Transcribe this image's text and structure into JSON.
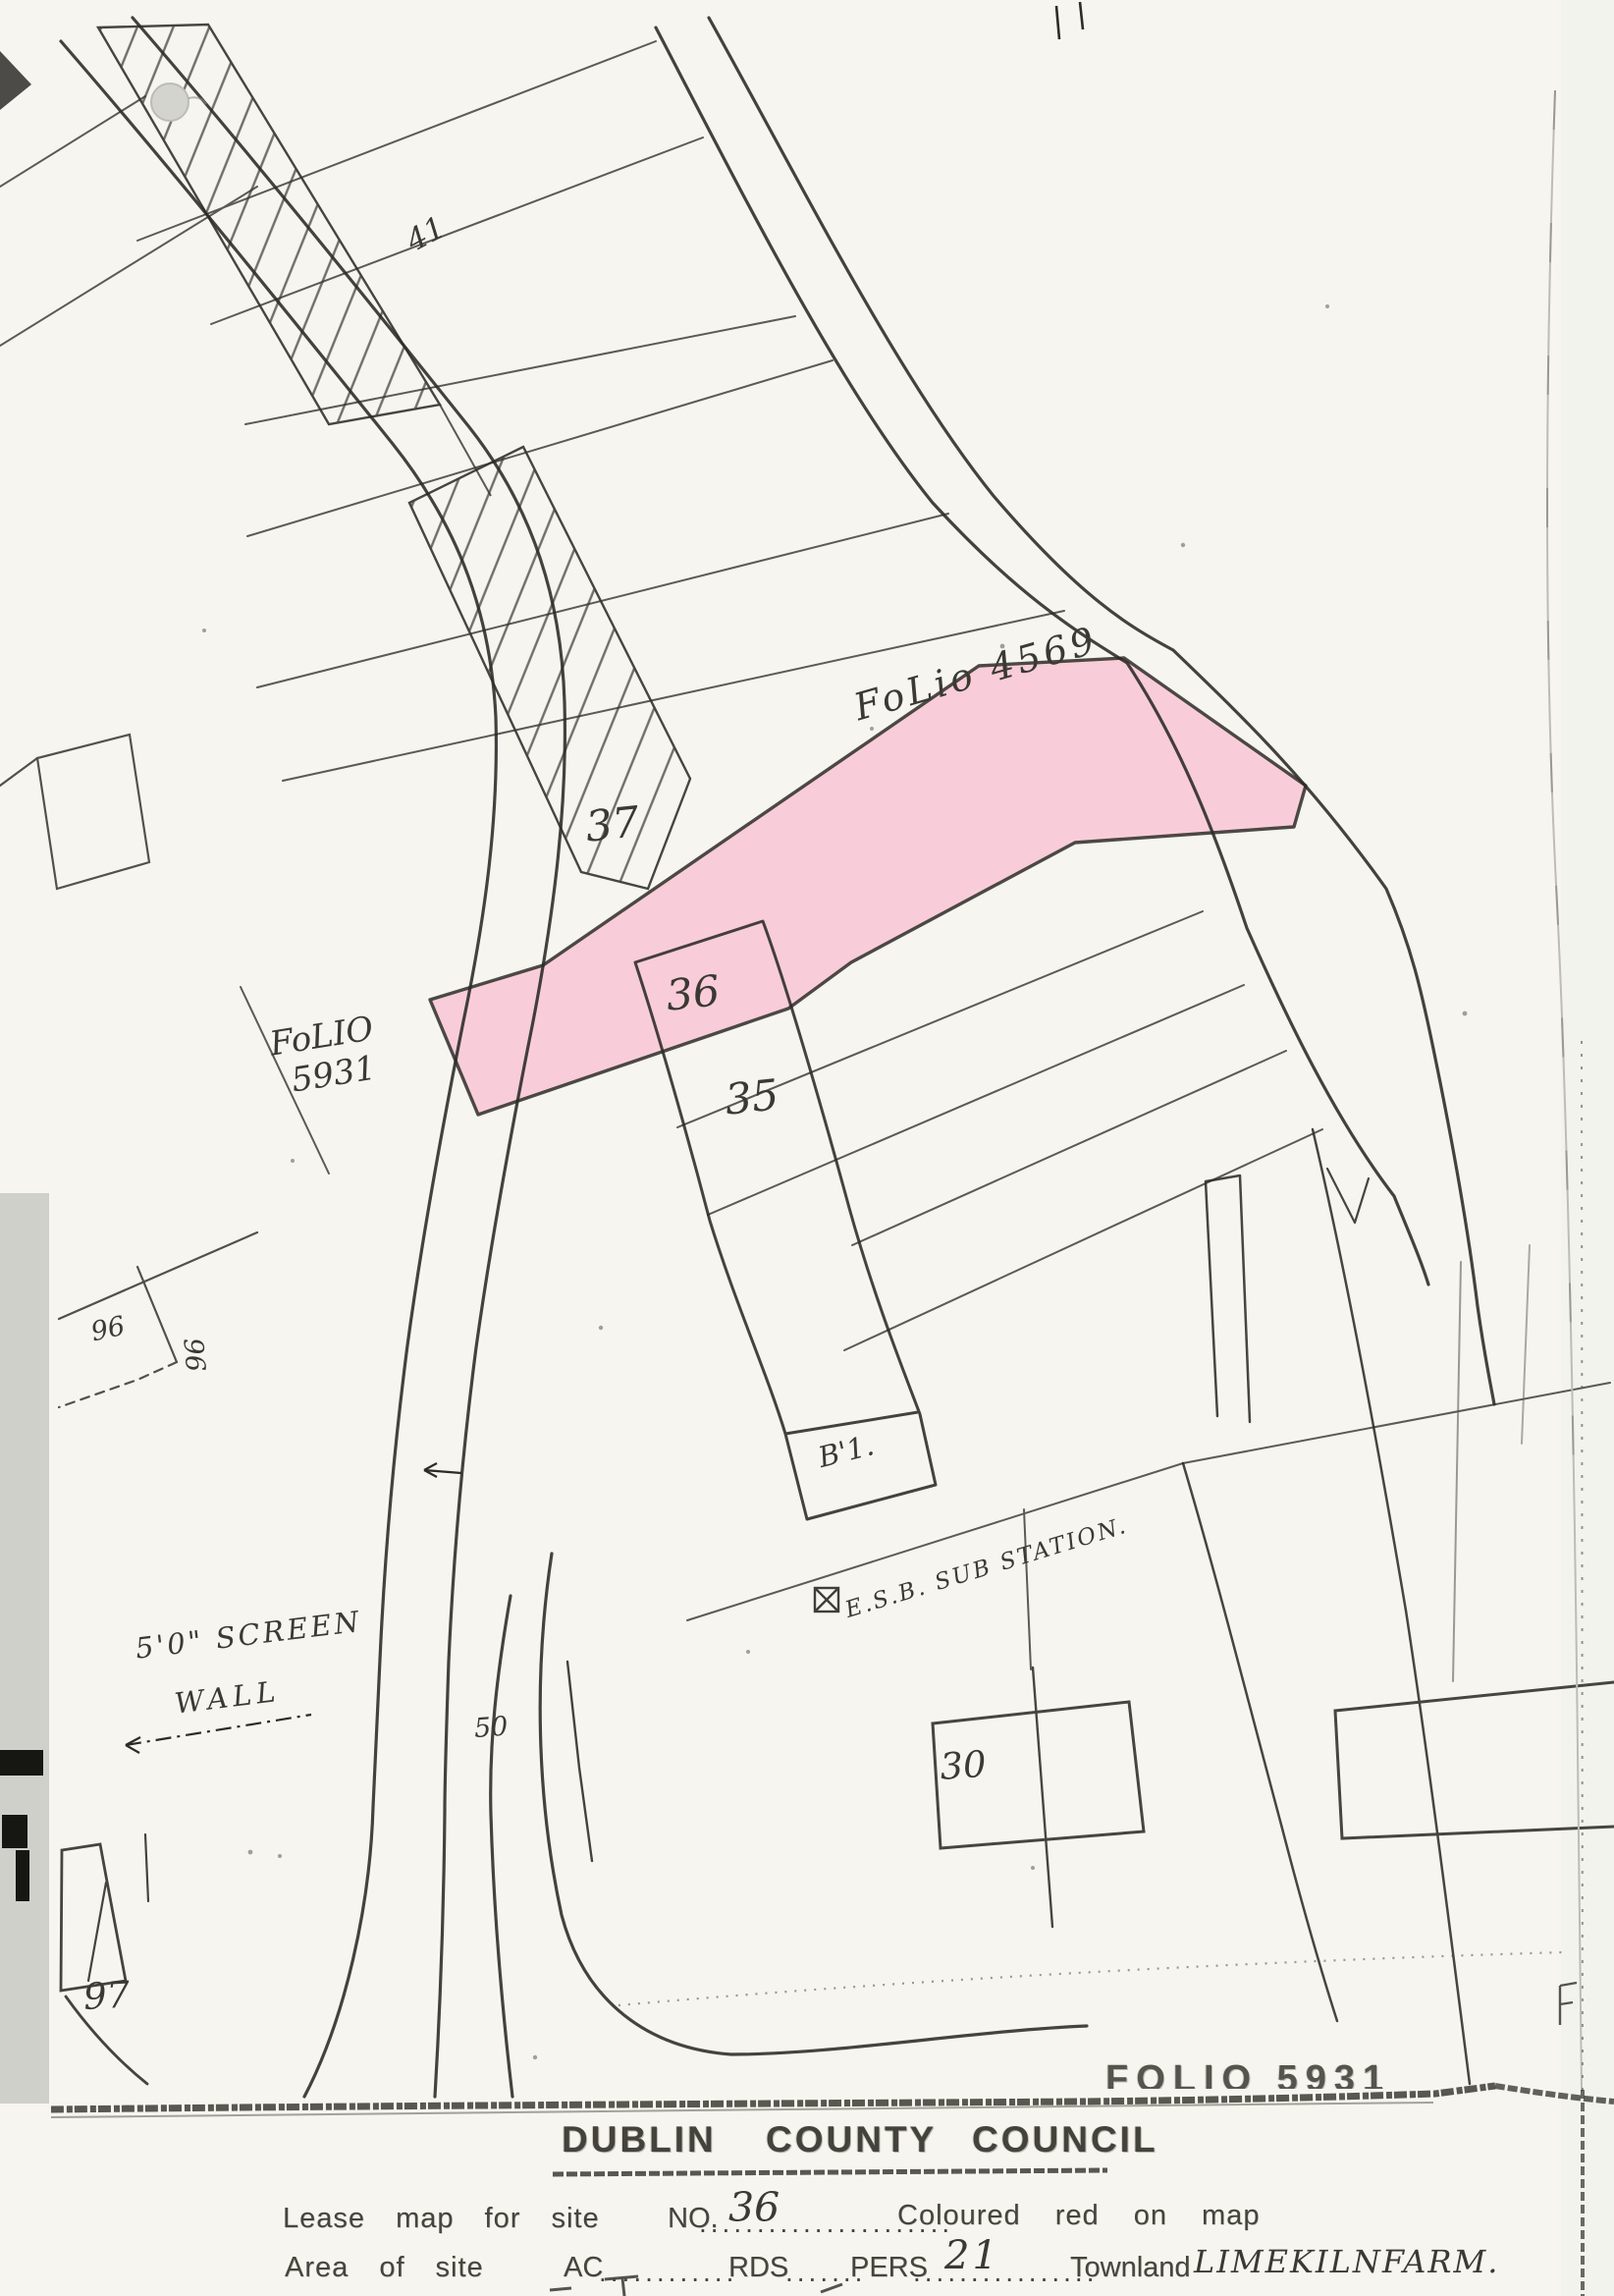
{
  "map": {
    "highlight_color": "#f8cdd9",
    "labels": {
      "folio_upper": "FoLio 4569",
      "folio_left_1": "FoLIO",
      "folio_left_2": "5931",
      "folio_bottom_partial": "FOLIO 5931",
      "site_41": "41",
      "site_37": "37",
      "site_36": "36",
      "site_35": "35",
      "site_96_a": "96",
      "site_96_b": "96",
      "site_30": "30",
      "site_97": "97",
      "site_b1": "B'1.",
      "road_50": "50",
      "esb_substation": "E.S.B. SUB STATION.",
      "screen_wall_1": "5'0\" SCREEN",
      "screen_wall_2": "WALL"
    }
  },
  "title_block": {
    "council_title": [
      "DUBLIN",
      "COUNTY",
      "COUNCIL"
    ],
    "lease_prefix": "Lease map for site",
    "no_label": "NO.",
    "site_no_value": "36",
    "dots_lease": "......................",
    "coloured_note": "Coloured red on map",
    "area_prefix": "Area of site",
    "ac_label": "AC",
    "dots_a": "............",
    "rds_label": "RDS",
    "dots_b": ".......",
    "pers_label": "PERS",
    "dots_c": "................",
    "pers_value": "21",
    "townland_label": "Townland",
    "townland_value": "LIMEKILNFARM."
  }
}
